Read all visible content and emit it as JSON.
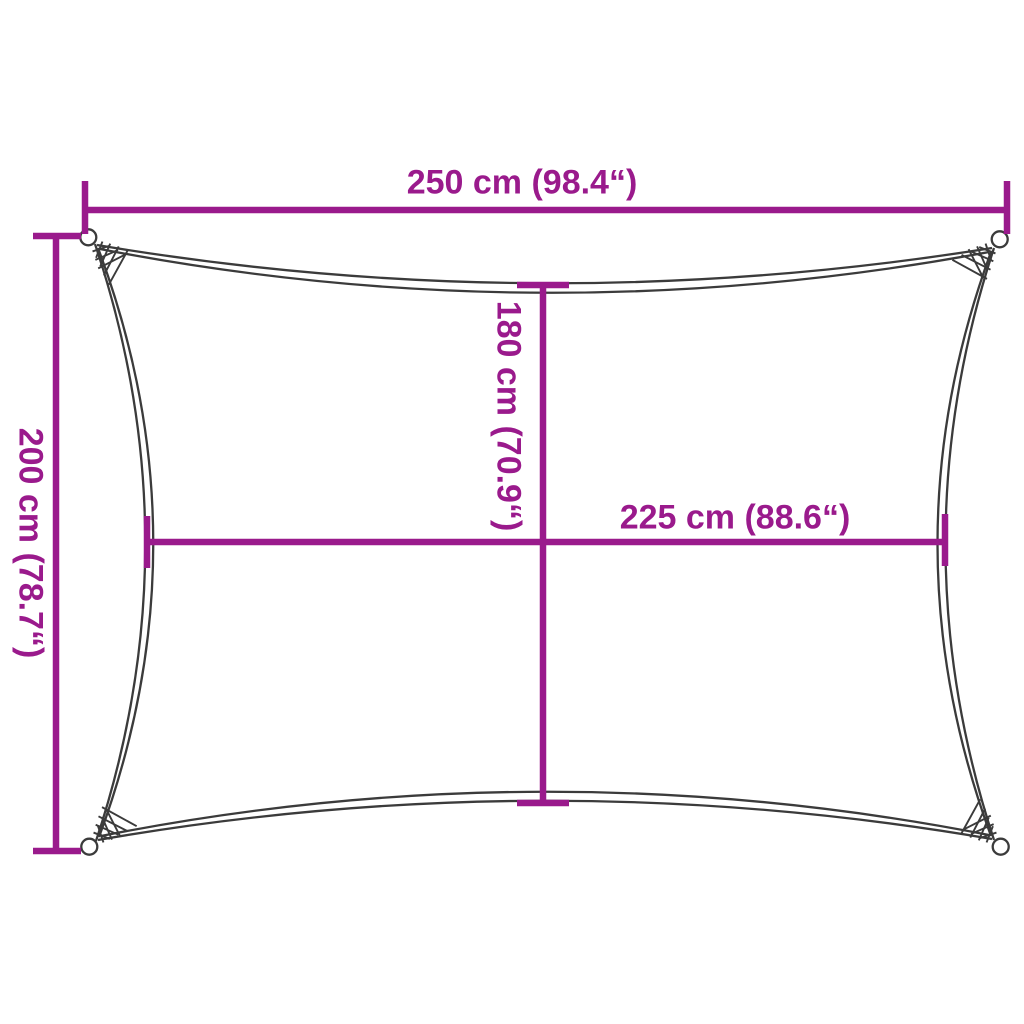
{
  "labels": {
    "top_width": "250 cm (98.4“)",
    "left_height": "200 cm (78.7“)",
    "inner_height": "180 cm (70.9“)",
    "inner_width": "225 cm (88.6“)"
  },
  "colors": {
    "accent": "#9a1a8c",
    "outline": "#3b3b3b",
    "background": "#ffffff"
  }
}
